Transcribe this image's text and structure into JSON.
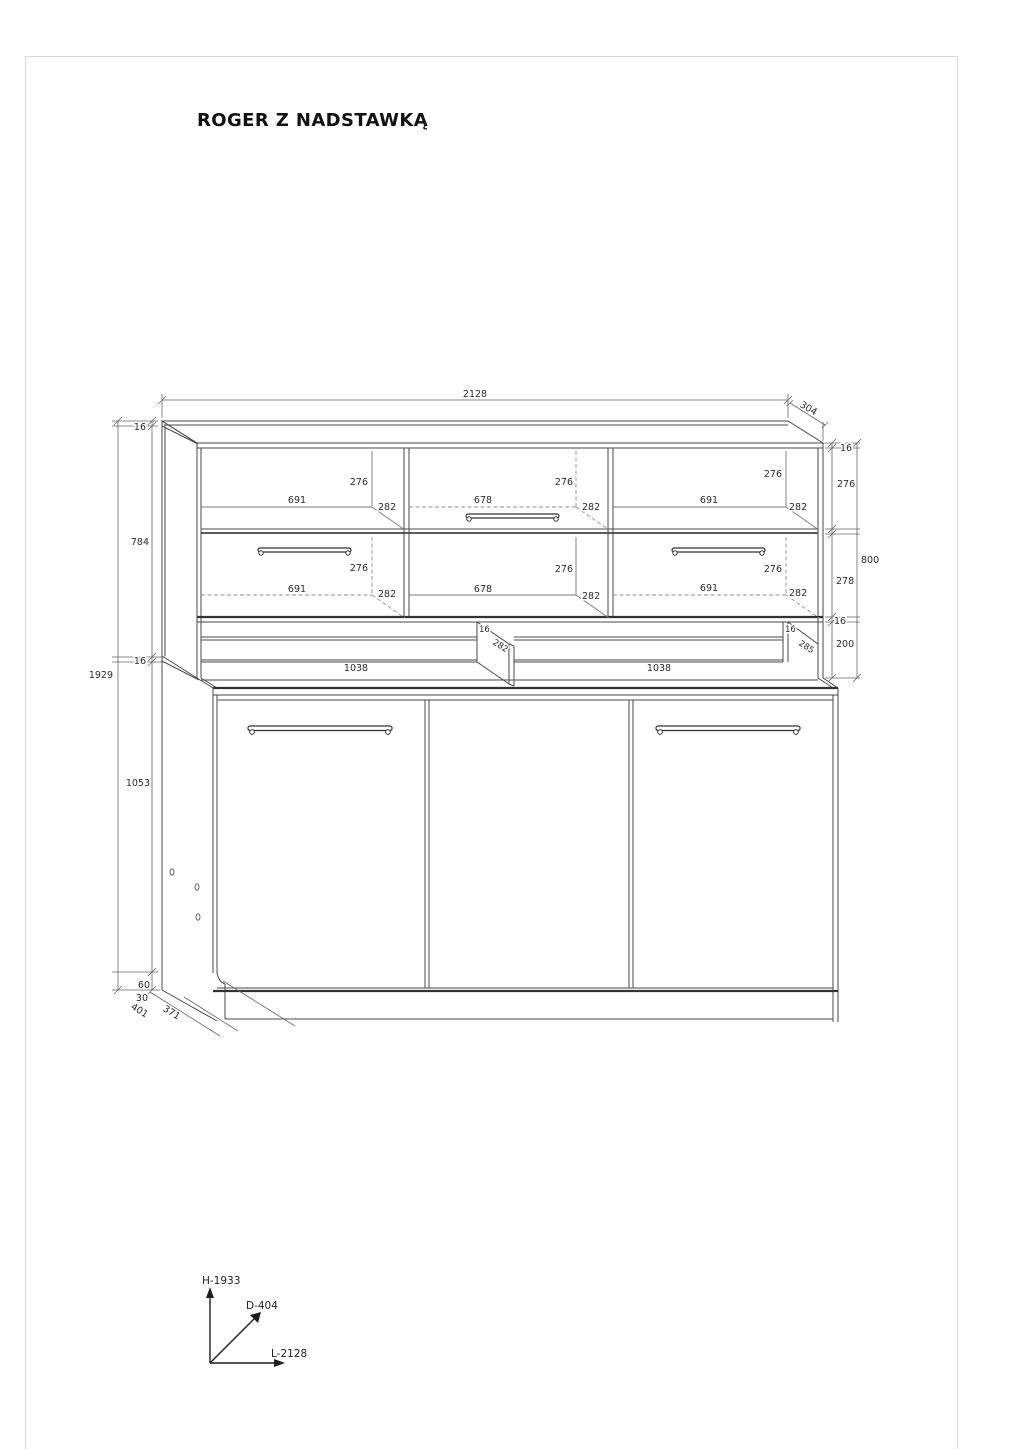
{
  "title": "ROGER Z NADSTAWKĄ",
  "dims": {
    "width_total": "2128",
    "depth_top": "304",
    "thk_top": "16",
    "thk_r_top": "16",
    "hutch_inner_h": "784",
    "height_total": "1929",
    "thk_hutch_bottom_left": "16",
    "base_h": "1053",
    "plinth_h": "60",
    "plinth_recess": "30",
    "depth_total": "401",
    "depth_carcass": "371",
    "row_top_h": "276",
    "hutch_h": "800",
    "row_bottom_h": "278",
    "thk_r_bottom": "16",
    "gap_h": "200",
    "gap_div_thk": "16",
    "gap_div_d": "282",
    "gap_right_thk": "16",
    "gap_right_d": "285",
    "gap_open_left": "1038",
    "gap_open_right": "1038"
  },
  "compartments": {
    "tl": {
      "w": "691",
      "h": "276",
      "d": "282"
    },
    "tm": {
      "w": "678",
      "h": "276",
      "d": "282"
    },
    "tr": {
      "w": "691",
      "h": "276",
      "d": "282"
    },
    "bl": {
      "w": "691",
      "h": "276",
      "d": "282"
    },
    "bm": {
      "w": "678",
      "h": "276",
      "d": "282"
    },
    "br": {
      "w": "691",
      "h": "276",
      "d": "282"
    }
  },
  "axes": {
    "height": "H-1933",
    "depth": "D-404",
    "length": "L-2128"
  },
  "colors": {
    "line": "#4a4a4a",
    "dim": "#666666",
    "text": "#2b2b2b",
    "page_border": "#d8d8d8"
  }
}
